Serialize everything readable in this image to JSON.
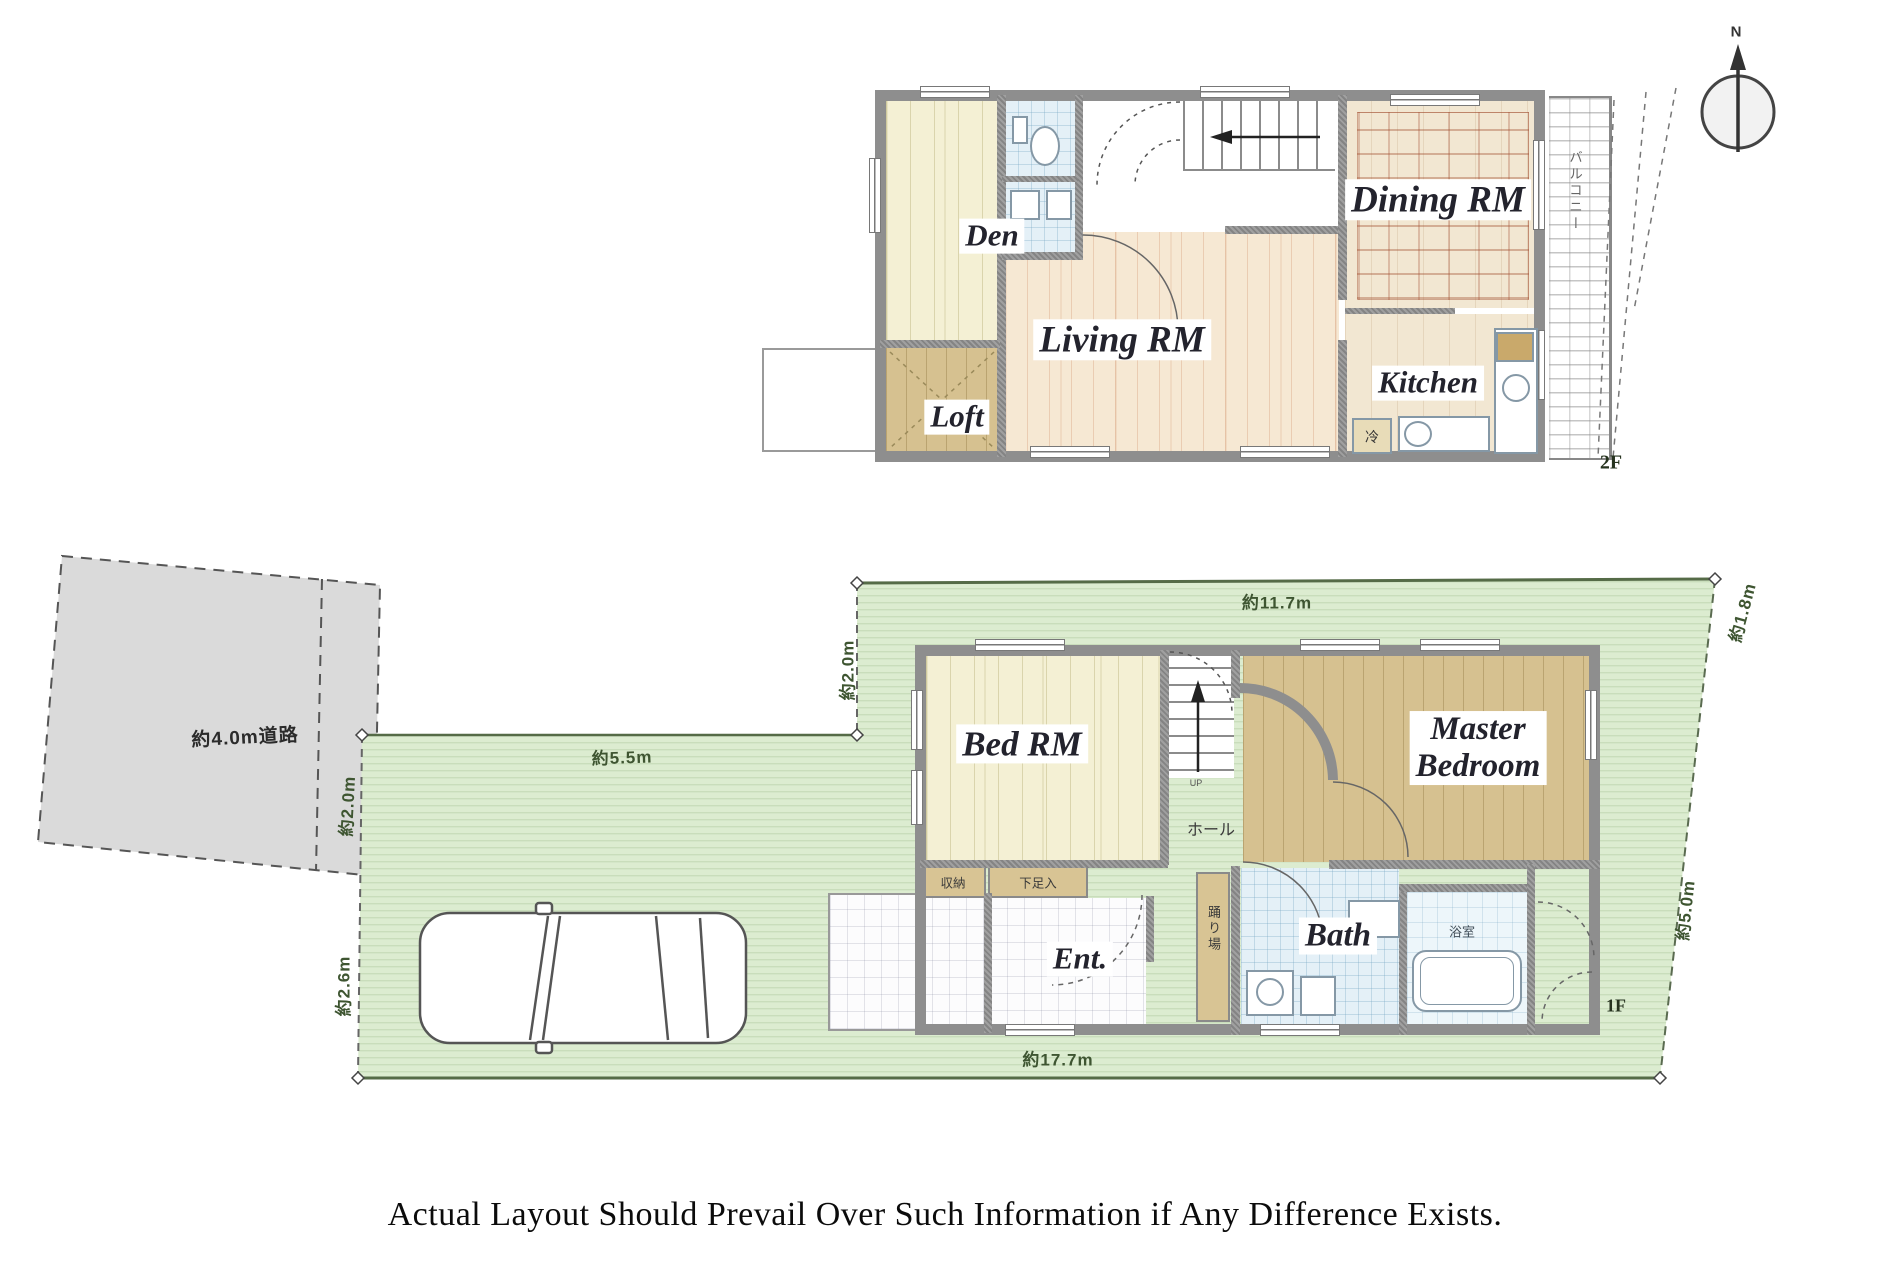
{
  "caption": "Actual Layout Should Prevail Over Such Information if Any Difference Exists.",
  "compass": {
    "north_label": "N"
  },
  "floor2": {
    "floor_label": "2F",
    "room_den": "Den",
    "room_loft": "Loft",
    "room_living": "Living RM",
    "room_dining": "Dining RM",
    "room_kitchen": "Kitchen",
    "balcony_label": "バルコニー",
    "fridge_label": "冷"
  },
  "floor1": {
    "floor_label": "1F",
    "room_bed": "Bed RM",
    "room_master_line1": "Master",
    "room_master_line2": "Bedroom",
    "room_bath": "Bath",
    "room_bath_jp": "浴室",
    "room_entrance": "Ent.",
    "room_hall": "ホール",
    "landing_label": "踊り場",
    "storage_label": "収納",
    "shoe_cabinet_label": "下足入",
    "stairs_up_label": "UP"
  },
  "site": {
    "road_label": "約4.0m道路",
    "dim_top": "約11.7m",
    "dim_bottom": "約17.7m",
    "dim_left_upper": "約2.0m",
    "dim_road_strip": "約2.0m",
    "dim_left_lower": "約2.6m",
    "dim_right_upper": "約1.8m",
    "dim_right_lower": "約5.0m",
    "dim_driveway": "約5.5m"
  },
  "colors": {
    "lot_green": "#dcecd0",
    "road_gray": "#dadada",
    "wall_gray": "#8e8e8e",
    "room_yellow": "#f4f0d4",
    "room_tan": "#d6c190",
    "room_wood": "#f6e8d3",
    "room_blue": "#e4f0f7",
    "dim_text": "#3e5531"
  }
}
